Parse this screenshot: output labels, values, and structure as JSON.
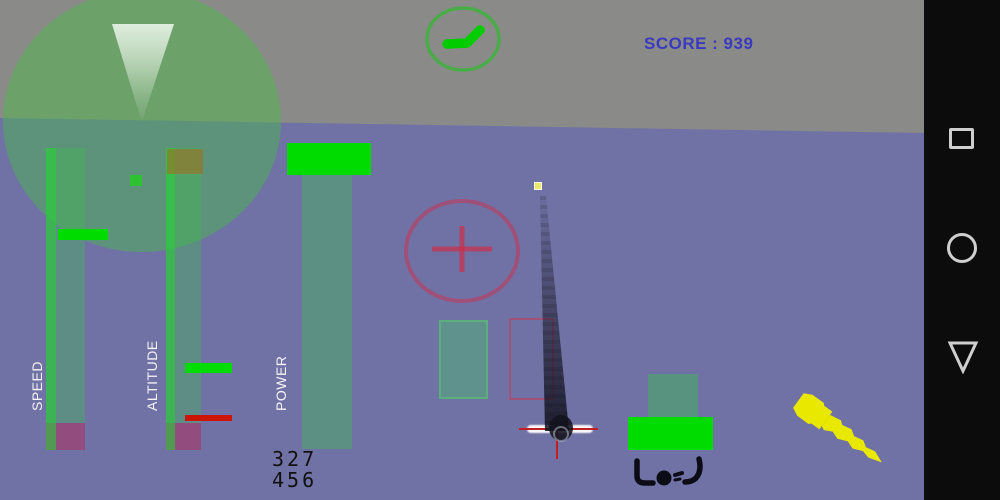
{
  "screen": {
    "platform": "android-landscape-game"
  },
  "hud": {
    "score_text": "SCORE : 939",
    "score_value": 939,
    "gauges": {
      "speed": {
        "label": "SPEED"
      },
      "altitude": {
        "label": "ALTITUDE"
      },
      "power": {
        "label": "POWER",
        "readout": [
          "327",
          "456"
        ]
      }
    },
    "radar": {
      "description": "radar circle with forward view cone and blip"
    },
    "aircraft_indicator": {
      "description": "green aircraft silhouette inside ring"
    },
    "crash_marker_glyph": "L●J"
  },
  "colors": {
    "sky": "#8a8a88",
    "ground": "#7072a5",
    "hud_green_translucent": "rgba(62,186,80,0.40)",
    "bright_green": "#00dc00",
    "indicator_red": "#cc1505",
    "reticle_red": "#cd2d4b",
    "score_blue": "#3a3abf",
    "screw_yellow": "#e8e800",
    "smoke_dark": "#16161c",
    "crash_glyph_black": "#0c0c16",
    "nav_bg": "#0c0c0c",
    "nav_icon": "#cfcfcf"
  },
  "nav_bar": {
    "buttons": [
      {
        "name": "recents",
        "icon": "square-icon"
      },
      {
        "name": "home",
        "icon": "circle-icon"
      },
      {
        "name": "back",
        "icon": "triangle-down-icon"
      }
    ]
  }
}
